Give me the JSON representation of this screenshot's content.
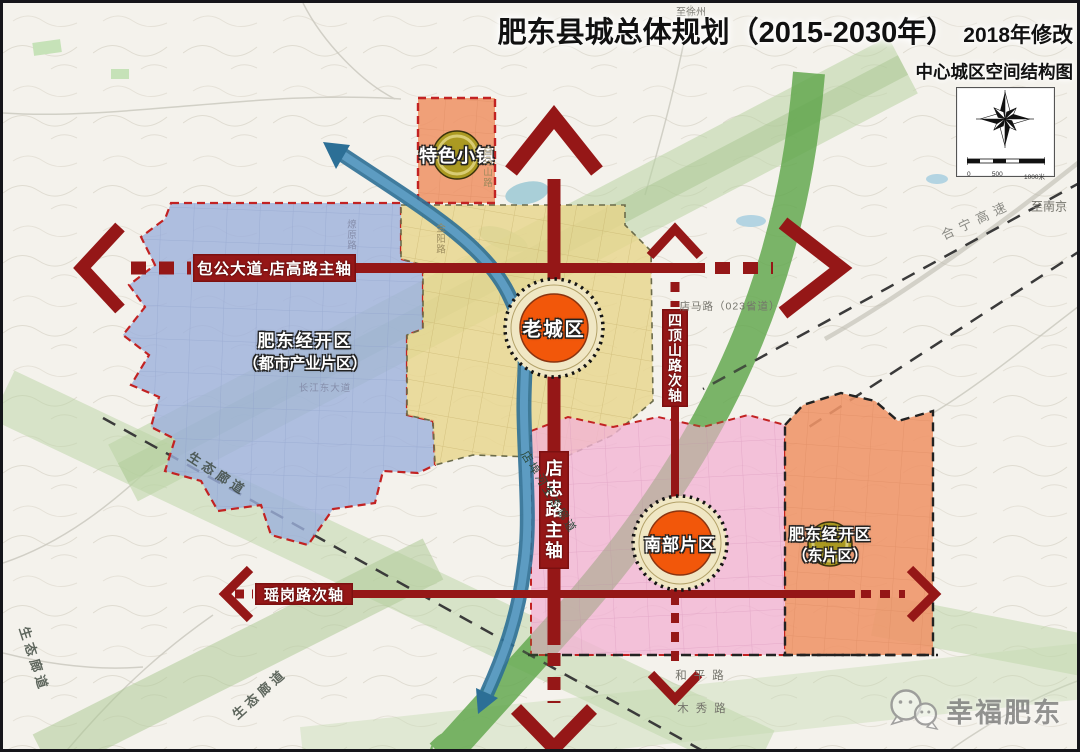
{
  "title": {
    "main": "肥东县城总体规划（2015-2030年）",
    "revision": "2018年修改",
    "subtitle": "中心城区空间结构图"
  },
  "zones": {
    "special_town": {
      "label": "特色小镇"
    },
    "west_dev": {
      "line1": "肥东经开区",
      "line2": "（都市产业片区）"
    },
    "old_town": {
      "label": "老城区"
    },
    "south": {
      "label": "南部片区"
    },
    "east_dev": {
      "line1": "肥东经开区",
      "line2": "（东片区）"
    }
  },
  "axes": {
    "baogong": {
      "label": "包公大道-店高路主轴"
    },
    "dianzhong": {
      "label": "店忠路主轴"
    },
    "sidingshan": {
      "label": "四顶山路次轴"
    },
    "yaogang": {
      "label": "瑶岗路次轴"
    }
  },
  "labels": {
    "eco1": "生态廊道",
    "eco2": "生态廊道",
    "eco3": "生态廊道",
    "dianbu_river": "店埠河生态廊道",
    "hening": "合宁高速",
    "to_nanjing": "至南京",
    "to_xuzhou": "至徐州",
    "dianma": "店马路（023省道）",
    "heping": "和平路",
    "muxiu": "木秀路",
    "liaoyuan": "燎原路",
    "jinyang": "金阳路",
    "baimashan": "白马山路",
    "changjiang": "长江东大道"
  },
  "scalebar": {
    "t0": "0",
    "t1": "500",
    "t2": "1000米"
  },
  "watermark": {
    "text": "幸福肥东"
  },
  "colors": {
    "axis_red": "#951717",
    "zone_blue": "#9cb0dc",
    "zone_yellow": "#e8d58c",
    "zone_pink": "#f2b4d4",
    "zone_orange": "#ef9468",
    "corridor_green": "#63a84f",
    "river_blue": "#337ca9",
    "circle_orange": "#f2570a",
    "badge_olive": "#ab9a22"
  }
}
